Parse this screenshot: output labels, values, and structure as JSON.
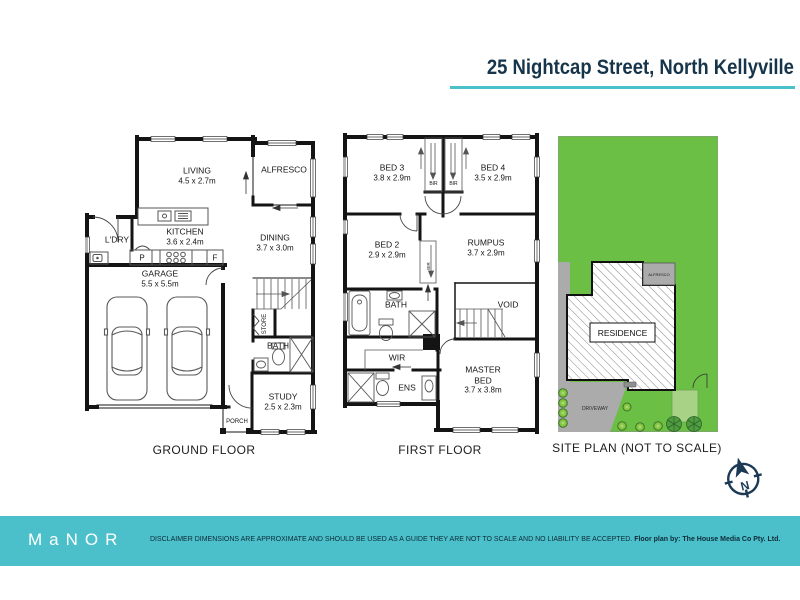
{
  "header": {
    "address": "25 Nightcap Street, North Kellyville"
  },
  "plans": {
    "ground": {
      "caption": "GROUND FLOOR",
      "living": {
        "name": "LIVING",
        "dims": "4.5 x 2.7m"
      },
      "alfresco": {
        "name": "ALFRESCO"
      },
      "ldry": {
        "name": "L'DRY"
      },
      "kitchen": {
        "name": "KITCHEN",
        "dims": "3.6 x 2.4m"
      },
      "dining": {
        "name": "DINING",
        "dims": "3.7 x 3.0m"
      },
      "garage": {
        "name": "GARAGE",
        "dims": "5.5 x 5.5m"
      },
      "pantry": "P",
      "fridge": "F",
      "store": "STORE",
      "bath": {
        "name": "BATH"
      },
      "study": {
        "name": "STUDY",
        "dims": "2.5 x 2.3m"
      },
      "porch": {
        "name": "PORCH"
      }
    },
    "first": {
      "caption": "FIRST FLOOR",
      "bed3": {
        "name": "BED 3",
        "dims": "3.8 x 2.9m"
      },
      "bed4": {
        "name": "BED 4",
        "dims": "3.5 x 2.9m"
      },
      "bir": "BIR",
      "bed2": {
        "name": "BED 2",
        "dims": "2.9 x 2.9m"
      },
      "rumpus": {
        "name": "RUMPUS",
        "dims": "3.7 x 2.9m"
      },
      "bath": {
        "name": "BATH"
      },
      "void": {
        "name": "VOID"
      },
      "wir": {
        "name": "WIR"
      },
      "ens": {
        "name": "ENS"
      },
      "master": {
        "line1": "MASTER",
        "line2": "BED",
        "dims": "3.7 x 3.8m"
      }
    },
    "site": {
      "caption": "SITE PLAN (NOT TO SCALE)",
      "residence": "RESIDENCE",
      "alfresco": "ALFRESCO",
      "driveway": "DRIVEWAY"
    }
  },
  "compass": {
    "north": "N"
  },
  "footer": {
    "logo": "MaNOR",
    "disclaimer": "DISCLAIMER DIMENSIONS ARE APPROXIMATE AND SHOULD BE USED AS A GUIDE THEY ARE NOT TO SCALE AND NO LIABILITY BE ACCEPTED.",
    "credit": "Floor plan by: The House Media Co Pty. Ltd."
  },
  "colors": {
    "accent_teal": "#4bc0cb",
    "navy": "#16344a",
    "grass_green": "#6cbf45",
    "driveway_grey": "#ababab"
  }
}
